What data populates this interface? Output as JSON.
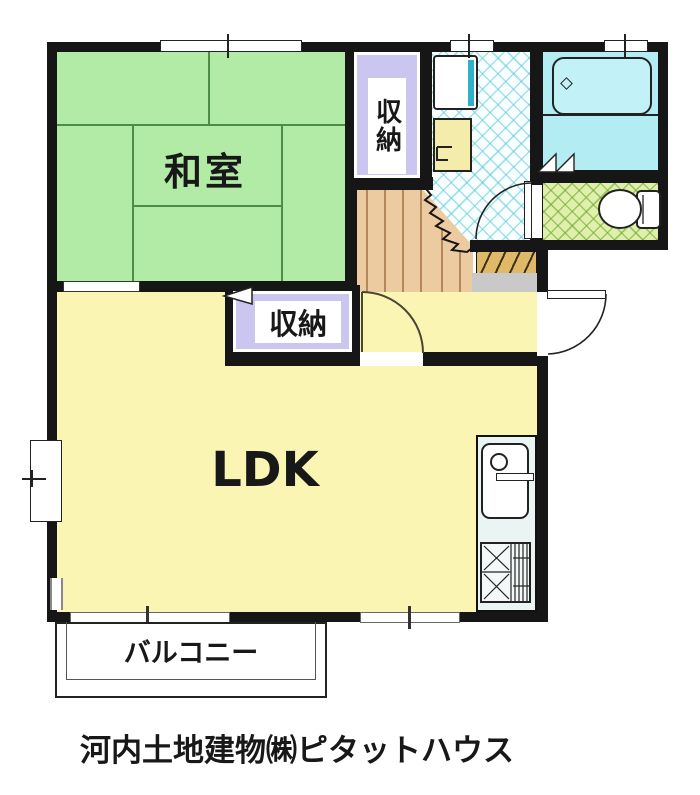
{
  "floor_plan": {
    "rooms": {
      "japanese_room": {
        "label": "和室"
      },
      "storage_upper": {
        "label": "収納"
      },
      "storage_lower": {
        "label": "収納"
      },
      "ldk": {
        "label": "LDK"
      },
      "balcony": {
        "label": "バルコニー"
      }
    },
    "fixtures": [
      "bathtub",
      "toilet",
      "washing-machine-pan",
      "wash-basin",
      "kitchen-sink",
      "gas-stove",
      "staircase",
      "entrance-step",
      "entrance-door"
    ],
    "footer": {
      "company_label": "河内土地建物㈱ピタットハウス"
    },
    "colors": {
      "tatami_green": "#b2eba6",
      "storage_lavender": "#cac6ef",
      "ldk_yellow": "#fbf5b4",
      "hall_wood": "#eccba1",
      "bathroom_cyan": "#b4ecf4",
      "toilet_floor": "#e0f0ac",
      "entrance_gray": "#c9c9c9",
      "step_tan": "#dfb967",
      "basin_yellow": "#f4ecaa",
      "wall_black": "#161616"
    }
  }
}
